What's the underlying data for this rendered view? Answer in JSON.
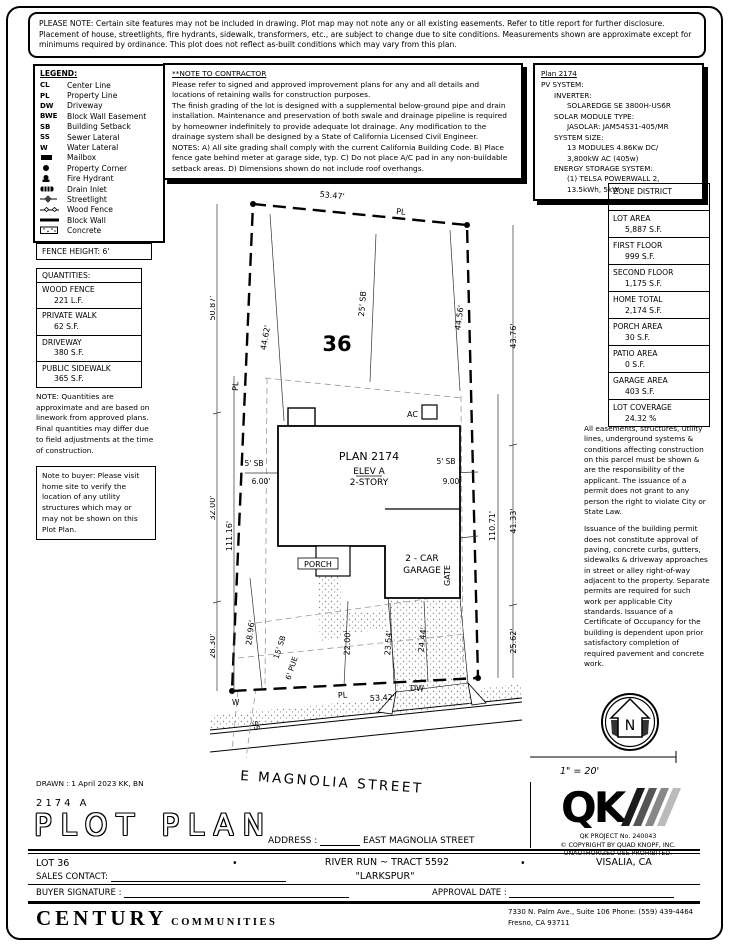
{
  "page": {
    "top_note": "PLEASE NOTE:  Certain site features may not be included in drawing.  Plot map may not note any or all existing easements. Refer to title report for further disclosure.  Placement of house, streetlights, fire hydrants, sidewalk, transformers, etc., are subject to change due to site conditions.  Measurements shown are approximate except for minimums required by ordinance.  This plot does not reflect as-built conditions which may vary from this plan."
  },
  "legend": {
    "title": "LEGEND:",
    "items": [
      {
        "symbol": "CL",
        "label": "Center Line"
      },
      {
        "symbol": "PL",
        "label": "Property Line"
      },
      {
        "symbol": "DW",
        "label": "Driveway"
      },
      {
        "symbol": "BWE",
        "label": "Block Wall Easement"
      },
      {
        "symbol": "SB",
        "label": "Building Setback"
      },
      {
        "symbol": "SS",
        "label": "Sewer Lateral"
      },
      {
        "symbol": "W",
        "label": "Water Lateral"
      },
      {
        "symbol": "mailbox-icon",
        "label": "Mailbox"
      },
      {
        "symbol": "property-corner-icon",
        "label": "Property Corner"
      },
      {
        "symbol": "fire-hydrant-icon",
        "label": "Fire Hydrant"
      },
      {
        "symbol": "drain-inlet-icon",
        "label": "Drain Inlet"
      },
      {
        "symbol": "streetlight-icon",
        "label": "Streetlight"
      },
      {
        "symbol": "wood-fence-icon",
        "label": "Wood Fence"
      },
      {
        "symbol": "block-wall-icon",
        "label": "Block Wall"
      },
      {
        "symbol": "concrete-icon",
        "label": "Concrete"
      }
    ]
  },
  "contractor_note": {
    "title": "**NOTE TO CONTRACTOR",
    "para1": "Please refer to signed and approved improvement plans for any and all details and locations of retaining walls for construction purposes.",
    "para2": "The finish grading of the lot is designed with a supplemental below-ground pipe and drain installation.  Maintenance and preservation of both swale and drainage pipeline is required by homeowner indefinitely to provide adequate lot drainage.  Any modification to the drainage system shall be designed by a State of California Licensed Civil Engineer.",
    "para3": "NOTES:  A) All site grading shall comply with the current California Building Code.  B) Place fence gate behind meter at garage side, typ.  C) Do not place A/C pad in any non-buildable setback areas.  D) Dimensions shown do not include roof overhangs."
  },
  "pv": {
    "title": "Plan 2174",
    "lines": [
      {
        "text": "PV SYSTEM:"
      },
      {
        "text": "INVERTER:"
      },
      {
        "text": "SOLAREDGE SE 3800H-US6R"
      },
      {
        "text": "SOLAR MODULE TYPE:"
      },
      {
        "text": "JASOLAR: JAM54S31-405/MR"
      },
      {
        "text": "SYSTEM SIZE:"
      },
      {
        "text": "13 MODULES 4.86Kw DC/"
      },
      {
        "text": "3,800kW AC (405w)"
      },
      {
        "text": "ENERGY STORAGE SYSTEM:"
      },
      {
        "text": "(1) TELSA POWERWALL 2,"
      },
      {
        "text": "13.5kWh, 5kW"
      }
    ]
  },
  "fence_height": "FENCE HEIGHT: 6'",
  "quantities": {
    "title": "QUANTITIES:",
    "rows": [
      {
        "label": "WOOD FENCE",
        "value": "221 L.F."
      },
      {
        "label": "PRIVATE WALK",
        "value": "62 S.F."
      },
      {
        "label": "DRIVEWAY",
        "value": "380 S.F."
      },
      {
        "label": "PUBLIC SIDEWALK",
        "value": "365 S.F."
      }
    ]
  },
  "notes": {
    "quantities_note": "NOTE: Quantities are approximate and are based on linework from approved plans.  Final quantities may differ due to field adjustments at the time of construction.",
    "buyer_note": "Note to buyer: Please visit home site to verify the location of any utility structures which may or may not be shown on this Plot Plan.",
    "easements_para1": "All easements, structures, utility lines, underground systems & conditions affecting construction on this parcel must be shown & are the responsibility of the applicant. The issuance of a permit does not grant to any person the right to violate City or State Law.",
    "easements_para2": "Issuance of the building permit does not constitute approval of paving, concrete curbs, gutters, sidewalks & driveway approaches in street or alley right-of-way adjacent to the property. Separate permits are required for such work per applicable City standards. Issuance of a Certificate of Occupancy for the building is dependent upon prior satisfactory completion of required pavement and concrete work."
  },
  "site_table": {
    "rows": [
      {
        "label": "ZONE DISTRICT",
        "value": "R-1-5"
      },
      {
        "label": "LOT AREA",
        "value": "5,887 S.F."
      },
      {
        "label": "FIRST FLOOR",
        "value": "999 S.F."
      },
      {
        "label": "SECOND FLOOR",
        "value": "1,175 S.F."
      },
      {
        "label": "HOME TOTAL",
        "value": "2,174 S.F."
      },
      {
        "label": "PORCH AREA",
        "value": "30 S.F."
      },
      {
        "label": "PATIO AREA",
        "value": "0 S.F."
      },
      {
        "label": "GARAGE AREA",
        "value": "403 S.F."
      },
      {
        "label": "LOT COVERAGE",
        "value": "24.32 %"
      }
    ]
  },
  "plot": {
    "lot_number": "36",
    "street_name": "E MAGNOLIA STREET",
    "house": {
      "line1": "PLAN 2174",
      "line2": "ELEV A",
      "line3": "2-STORY"
    },
    "garage": {
      "line1": "2 - CAR",
      "line2": "GARAGE"
    },
    "porch": "PORCH",
    "gate": "GATE",
    "ac": "AC",
    "dw": "DW",
    "pl": "PL",
    "w": "W",
    "ss": "SS",
    "dims": {
      "top": "53.47'",
      "bottom": "53.42'",
      "left_upper": "50.87'",
      "left_mid": "32.00'",
      "left_inner": "111.16'",
      "left_lower": "28.30'",
      "left_lower2": "28.96'",
      "right_upper": "43.76'",
      "right_mid": "41.33'",
      "right_inner": "110.71'",
      "right_lower": "25.62'",
      "diag_left": "44.62'",
      "diag_right": "44.56'",
      "front_setback": "25' SB",
      "side_setback_left": "5' SB",
      "side_left_dim": "6.00'",
      "side_setback_right": "5' SB",
      "side_right_dim": "9.00'",
      "rear_setback": "15' SB",
      "pue": "6' PUE",
      "walk1": "22.00'",
      "walk2": "23.54'",
      "walk3": "24.44'"
    },
    "compass_n": "N",
    "scale": "1\" = 20'"
  },
  "qk": {
    "logo": "QK",
    "project": "QK PROJECT No. 240043",
    "copyright1": "©  COPYRIGHT BY QUAD KNOPF, INC.",
    "copyright2": "UNAUTHORIZED USE PROHIBITED."
  },
  "titleblock": {
    "drawn": "DRAWN :  1 April 2023   KK, BN",
    "plan_code": "2174   A",
    "title": "PLOT PLAN",
    "address_label": "ADDRESS :",
    "address_value": "EAST MAGNOLIA STREET",
    "lot": "LOT 36",
    "bullet": "•",
    "tract": "RIVER RUN ~ TRACT 5592",
    "community": "\"LARKSPUR\"",
    "city": "VISALIA, CA",
    "sales_contact_label": "SALES CONTACT:",
    "buyer_signature_label": "BUYER SIGNATURE :",
    "approval_date_label": "APPROVAL DATE :"
  },
  "branding": {
    "century": "CENTURY",
    "communities": "COMMUNITIES",
    "address1": "7330 N. Palm Ave., Suite 106    Phone:  (559) 439-4464",
    "address2": "Fresno, CA  93711"
  }
}
